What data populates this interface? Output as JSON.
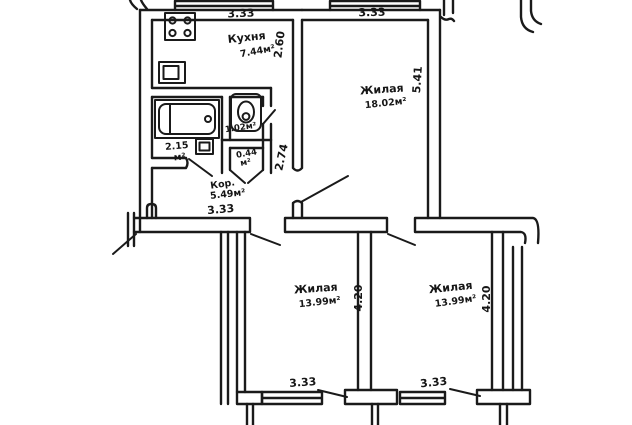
{
  "plan": {
    "rooms": {
      "kitchen": {
        "name": "Кухня",
        "area": "7.44м²"
      },
      "living_top": {
        "name": "Жилая",
        "area": "18.02м²"
      },
      "bathroom": {
        "area": "2.15",
        "unit": "м²"
      },
      "wc": {
        "area": "1.02м²"
      },
      "closet": {
        "area": "0.44",
        "unit": "м²"
      },
      "corridor": {
        "name": "Кор.",
        "area": "5.49м²"
      },
      "living_bottom_left": {
        "name": "Жилая",
        "area": "13.99м²"
      },
      "living_bottom_right": {
        "name": "Жилая",
        "area": "13.99м²"
      }
    },
    "dimensions": {
      "kitchen_width": "3.33",
      "kitchen_depth": "2.60",
      "living_top_width": "3.33",
      "living_top_depth": "5.41",
      "passage_height": "2.74",
      "corridor_width": "3.33",
      "living_bottom_left_depth": "4.20",
      "living_bottom_right_depth": "4.20",
      "living_bottom_left_window": "3.33",
      "living_bottom_right_window": "3.33"
    },
    "fixtures": {
      "stove": "stove-icon",
      "sink": "sink-icon",
      "bathtub": "bathtub-icon",
      "toilet": "toilet-icon"
    },
    "colors": {
      "ink": "#1a1a1a",
      "paper": "#ffffff"
    }
  }
}
